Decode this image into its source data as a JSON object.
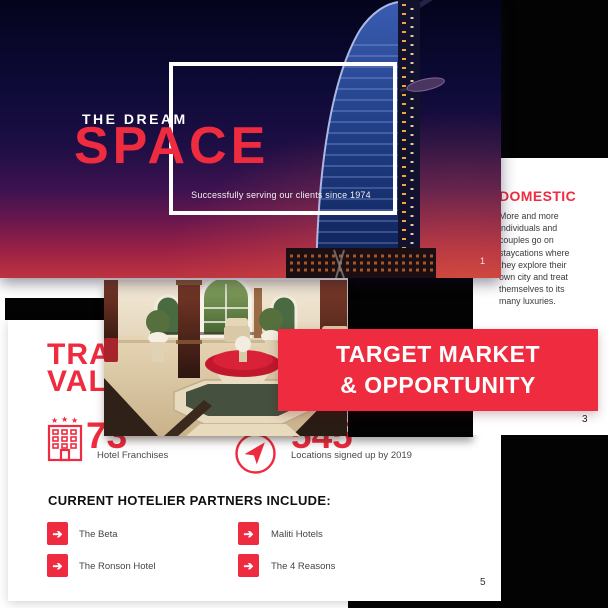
{
  "colors": {
    "accent": "#ee2b3f",
    "band": "#ee2b3f",
    "slide1_sky_top": "#04041c",
    "slide1_sky_bottom": "#bd3340"
  },
  "slide1": {
    "page_number": "1",
    "eyebrow": "THE DREAM",
    "title": "SPACE",
    "subtitle": "Successfully serving our clients since 1974",
    "background": "burj-al-arab-night-photo"
  },
  "slide3": {
    "page_number": "3",
    "heading": "DOMESTIC",
    "body_lines": [
      "More and more",
      "individuals and",
      "couples go on",
      "staycations where",
      "they explore their",
      "own city and treat",
      "themselves to its",
      "many luxuries."
    ],
    "band": {
      "line1": "TARGET MARKET",
      "line2": "& OPPORTUNITY"
    },
    "photo": "hotel-lobby-fountain-photo"
  },
  "slide5": {
    "page_number": "5",
    "title_lines": [
      "TRA",
      "VAL"
    ],
    "stats": [
      {
        "icon": "hotel-building-icon",
        "value": "73",
        "label": "Hotel Franchises"
      },
      {
        "icon": "compass-arrow-icon",
        "value": "545",
        "label": "Locations signed up by 2019"
      }
    ],
    "partners_heading": "CURRENT HOTELIER PARTNERS INCLUDE:",
    "partners": [
      "The Beta",
      "The Ronson Hotel",
      "Maliti Hotels",
      "The 4 Reasons"
    ]
  }
}
